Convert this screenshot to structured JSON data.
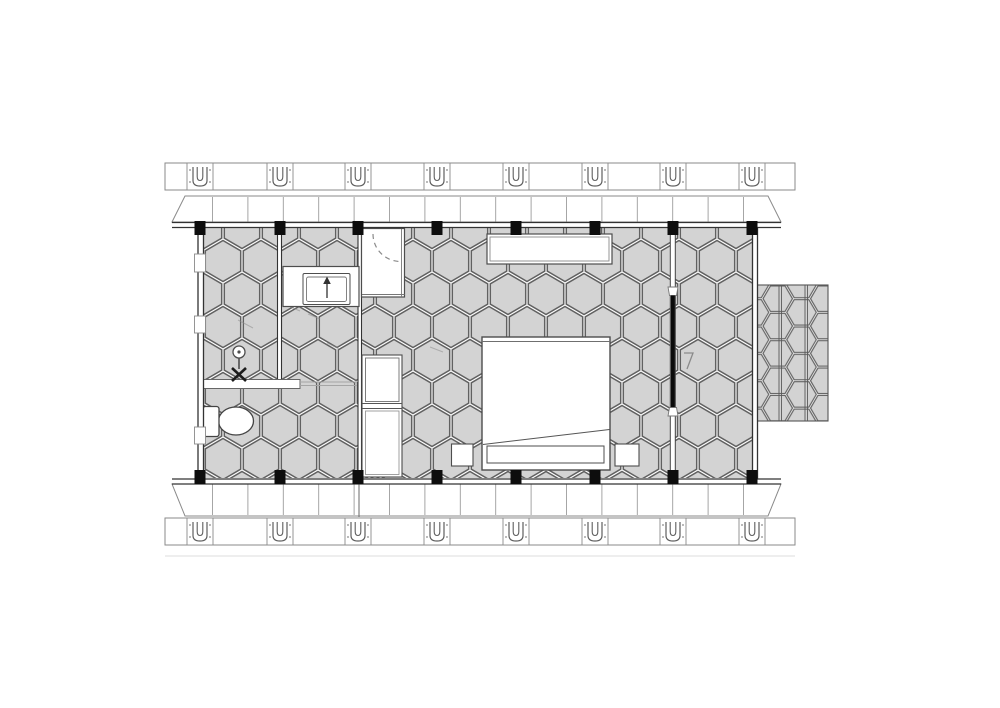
{
  "meta": {
    "type": "architectural-floor-plan",
    "subject": "small cabin plan: bathroom with toilet, basin and shower at left, bedroom with double bed at right, side deck on east wall",
    "view": "top-down",
    "style": "grayscale CAD line drawing, hexagonal tile flooring"
  },
  "canvas": {
    "width": 1000,
    "height": 708,
    "background": "#ffffff"
  },
  "palette": {
    "tile_fill": "#d3d3d3",
    "tile_line": "#616161",
    "wall_line": "#333333",
    "detail_line": "#777777",
    "light_line": "#9c9c9c",
    "post_fill": "#0d0d0d",
    "fixture_fill": "#ffffff",
    "fixture_stroke": "#4d4d4d",
    "door_panel": "#0a0a0a"
  },
  "structure": {
    "posts": {
      "count_top": 8,
      "count_bottom": 8,
      "x_positions": [
        200,
        280,
        358,
        437,
        516,
        595,
        673,
        752
      ],
      "top_y": 221,
      "bottom_y": 470,
      "width": 11,
      "height": 14
    },
    "anchor_strips": {
      "top": {
        "x": 165,
        "y": 163,
        "width": 630,
        "height": 27
      },
      "bottom": {
        "x": 165,
        "y": 518,
        "width": 630,
        "height": 27
      },
      "bracket_x_positions": [
        200,
        280,
        358,
        437,
        516,
        595,
        673,
        752
      ],
      "bracket_width": 26
    },
    "eave_bands": {
      "x_left": 172,
      "x_right": 781,
      "corner_inset": 13,
      "top": {
        "wall_y": 222,
        "outer_y": 196
      },
      "bottom": {
        "wall_y": 484,
        "outer_y": 516
      },
      "rafter_start_x": 212.5,
      "rafter_spacing": 35.4,
      "rafter_end_x": 751
    },
    "building": {
      "left": 197,
      "right": 758,
      "top": 222,
      "bottom": 484
    },
    "deck": {
      "left": 754,
      "top": 285,
      "right": 828,
      "bottom": 421
    }
  },
  "rooms": [
    {
      "name": "bathroom",
      "fixtures": [
        "toilet",
        "shower-column",
        "grab-rail",
        "vanity-sink",
        "shower-cabin",
        "tall-cabinet"
      ]
    },
    {
      "name": "bedroom",
      "fixtures": [
        "wardrobe",
        "double-bed",
        "pillows",
        "nightstand-left",
        "nightstand-right",
        "sliding-door"
      ]
    },
    {
      "name": "side-deck",
      "fixtures": []
    }
  ]
}
